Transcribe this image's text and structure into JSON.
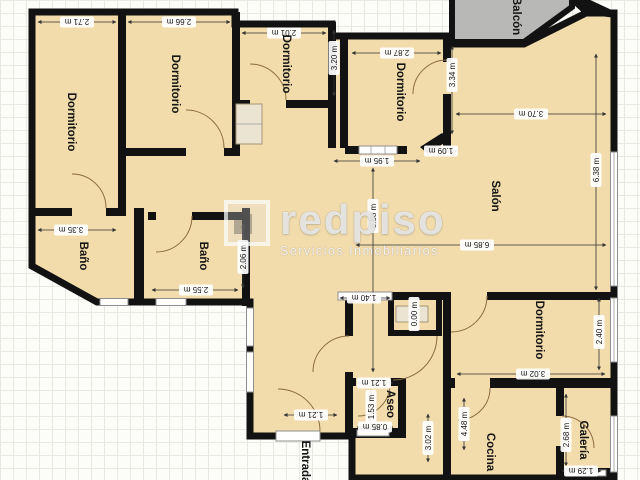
{
  "plan": {
    "rooms": [
      {
        "id": "bedroom-1",
        "label": "Dormitorio"
      },
      {
        "id": "bedroom-2",
        "label": "Dormitorio"
      },
      {
        "id": "bedroom-3",
        "label": "Dormitorio"
      },
      {
        "id": "bedroom-4",
        "label": "Dormitorio"
      },
      {
        "id": "balcony",
        "label": "Balcón"
      },
      {
        "id": "living-room",
        "label": "Salón"
      },
      {
        "id": "bathroom-1",
        "label": "Baño"
      },
      {
        "id": "bathroom-2",
        "label": "Baño"
      },
      {
        "id": "entrance",
        "label": "Entrada"
      },
      {
        "id": "toilet",
        "label": "Aseo"
      },
      {
        "id": "bedroom-5",
        "label": "Dormitorio"
      },
      {
        "id": "kitchen",
        "label": "Cocina"
      },
      {
        "id": "gallery",
        "label": "Galería"
      }
    ],
    "dims": [
      "2.71 m",
      "2.66 m",
      "2.01 m",
      "3.20 m",
      "2.87 m",
      "3.34 m",
      "3.70 m",
      "6.38 m",
      "1.95 m",
      "1.09 m",
      "6.85 m",
      "6.88 m",
      "3.35 m",
      "2.55 m",
      "2.06 m",
      "1.40 m",
      "0.00 m",
      "1.21 m",
      "1.53 m",
      "0.85 m",
      "1.21 m",
      "3.02 m",
      "4.48 m",
      "3.02 m",
      "2.40 m",
      "2.68 m",
      "1.29 m"
    ]
  },
  "watermark": {
    "brand": "redpiso",
    "tagline": "Servicios Inmobiliarios"
  },
  "colors": {
    "wall": "#121212",
    "room_fill": "#f3dcab",
    "balcony_fill": "#b8b8b6",
    "dim_text": "#151515"
  }
}
